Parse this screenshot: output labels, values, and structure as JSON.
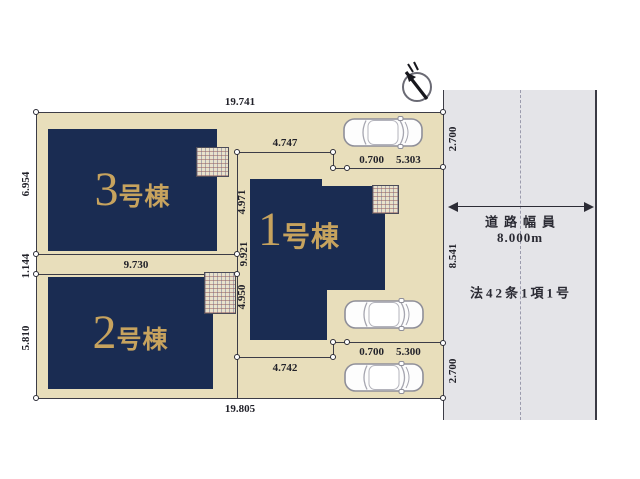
{
  "plot": {
    "dim_top": "19.741",
    "dim_bottom": "19.805",
    "dim_left_top": "6.954",
    "dim_left_mid": "1.144",
    "dim_left_bottom": "5.810",
    "dim_right_top": "2.700",
    "dim_right_mid": "8.541",
    "dim_right_bottom": "2.700",
    "dim_lot2_width": "9.730",
    "dim_top_inner": "4.747",
    "dim_top_offset": "0.700",
    "dim_top_parking": "5.303",
    "dim_bottom_inner": "4.742",
    "dim_bottom_offset": "0.700",
    "dim_bottom_parking": "5.300",
    "dim_mid_upper": "4.971",
    "dim_mid_total": "9.921",
    "dim_mid_lower": "4.950"
  },
  "buildings": {
    "b1": {
      "number": "1",
      "suffix": "号棟"
    },
    "b2": {
      "number": "2",
      "suffix": "号棟"
    },
    "b3": {
      "number": "3",
      "suffix": "号棟"
    }
  },
  "road": {
    "label": "道路幅員",
    "width": "8.000m",
    "law": "法42条1項1号"
  },
  "colors": {
    "plot": "#e8debb",
    "building": "#1a2c52",
    "gold": "#c7a35e",
    "road": "#e4e4e8",
    "line": "#3c3c46"
  }
}
